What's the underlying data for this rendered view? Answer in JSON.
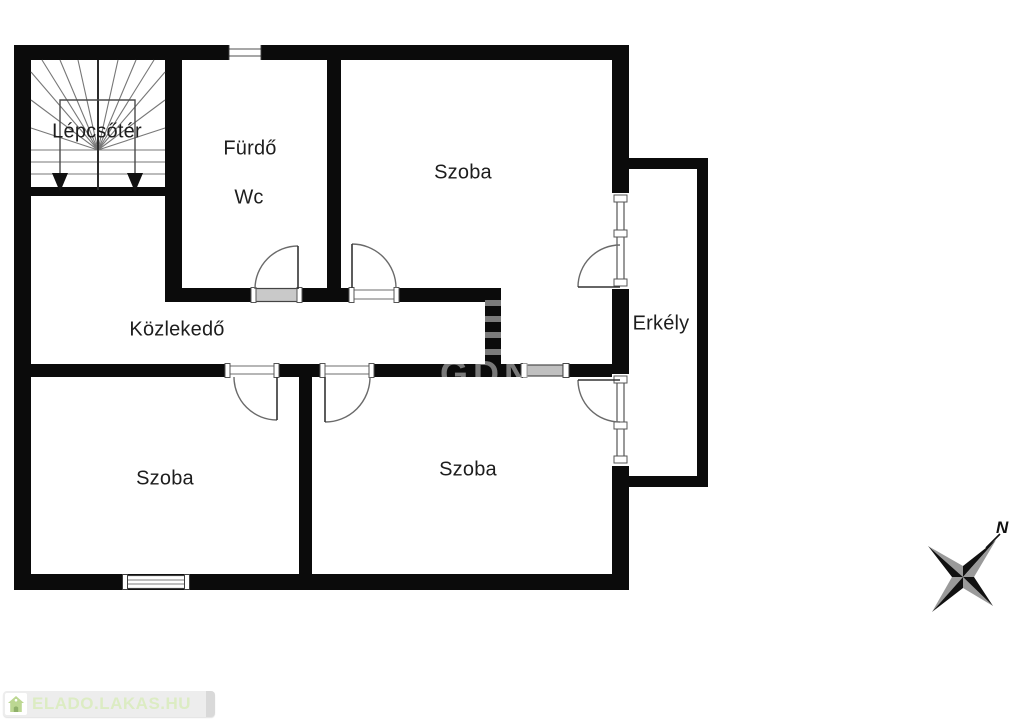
{
  "plan": {
    "rooms": {
      "stairwell": {
        "label": "Lépcsőtér"
      },
      "bathroom": {
        "label": "Fürdő"
      },
      "wc": {
        "label": "Wc"
      },
      "room_top": {
        "label": "Szoba"
      },
      "hallway": {
        "label": "Közlekedő"
      },
      "balcony": {
        "label": "Erkély"
      },
      "room_bottom_left": {
        "label": "Szoba"
      },
      "room_bottom_middle": {
        "label": "Szoba"
      }
    },
    "compass": {
      "north_label": "N"
    },
    "watermark": {
      "text": "GDN"
    },
    "colors": {
      "wall": "#0b0b0b",
      "thin_line": "#555555",
      "compass_gray": "#9a9a9a",
      "logo_background": "#ededed",
      "logo_text_color": "#dcecc3",
      "logo_house_green": "#bcd792"
    }
  },
  "footer_logo": {
    "text": "ELADO.LAKAS.HU"
  }
}
